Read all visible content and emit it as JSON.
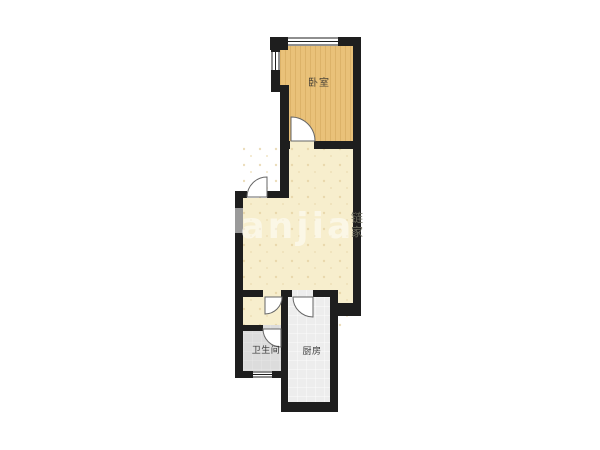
{
  "floorplan": {
    "background": "#ffffff",
    "wall_color": "#1e1e1e",
    "rooms": {
      "bedroom": {
        "label": "卧室",
        "floor_color": "#e9c179",
        "label_color": "#4d4538"
      },
      "living": {
        "floor_color": "#f7eecd"
      },
      "bathroom": {
        "label": "卫生间",
        "floor_color": "#dcdcdc",
        "label_color": "#383838"
      },
      "kitchen": {
        "label": "厨房",
        "floor_color": "#ededed",
        "label_color": "#383838"
      }
    },
    "features": {
      "shaft_color": "#9a9a9a",
      "window_color": "#ffffff",
      "door_stroke": "#666666"
    },
    "watermark": {
      "text": "lianjia",
      "color": "#ffffff",
      "seal_text": "链家",
      "seal_chars": [
        "链",
        "家"
      ]
    }
  }
}
